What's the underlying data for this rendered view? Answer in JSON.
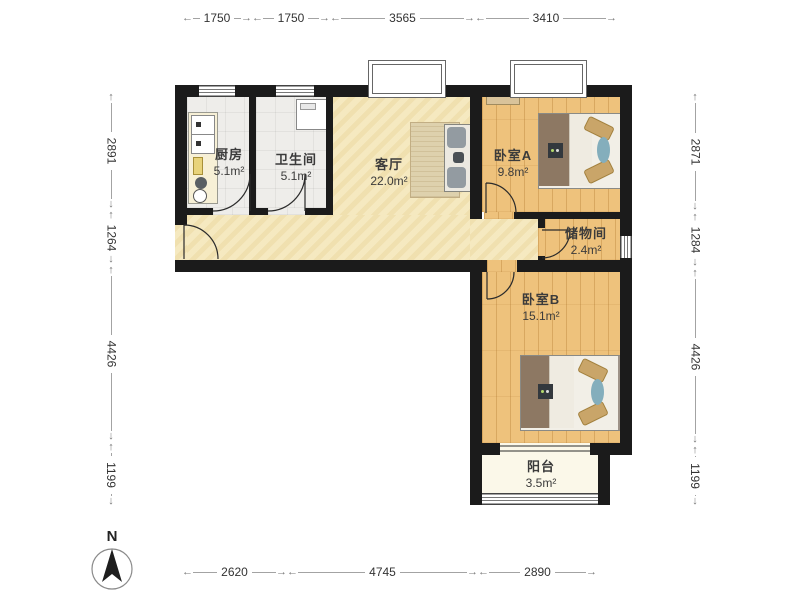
{
  "plan_title": "floor-plan",
  "compass": {
    "north_label": "N"
  },
  "rooms": {
    "kitchen": {
      "name": "厨房",
      "area": "5.1m²"
    },
    "bathroom": {
      "name": "卫生间",
      "area": "5.1m²"
    },
    "living": {
      "name": "客厅",
      "area": "22.0m²"
    },
    "bedroom_a": {
      "name": "卧室A",
      "area": "9.8m²"
    },
    "storage": {
      "name": "储物间",
      "area": "2.4m²"
    },
    "bedroom_b": {
      "name": "卧室B",
      "area": "15.1m²"
    },
    "balcony": {
      "name": "阳台",
      "area": "3.5m²"
    }
  },
  "dimensions": {
    "top": [
      "1750",
      "1750",
      "3565",
      "3410"
    ],
    "bottom": [
      "2620",
      "4745",
      "2890"
    ],
    "left": [
      "2891",
      "1264",
      "4426",
      "1199"
    ],
    "right": [
      "2871",
      "1284",
      "4426",
      "1199"
    ]
  },
  "colors": {
    "wall": "#1b1b1b",
    "wood_floor": "#eec27c",
    "living_floor": "#f4e7bc",
    "tile_floor": "#eeedea",
    "balcony_floor": "#fbf8e9",
    "bed_blanket": "#8d7863",
    "pillow": "#c9a569",
    "accent_blue": "#84aebc",
    "sofa_gray": "#939ba1",
    "dim_text": "#333333"
  }
}
